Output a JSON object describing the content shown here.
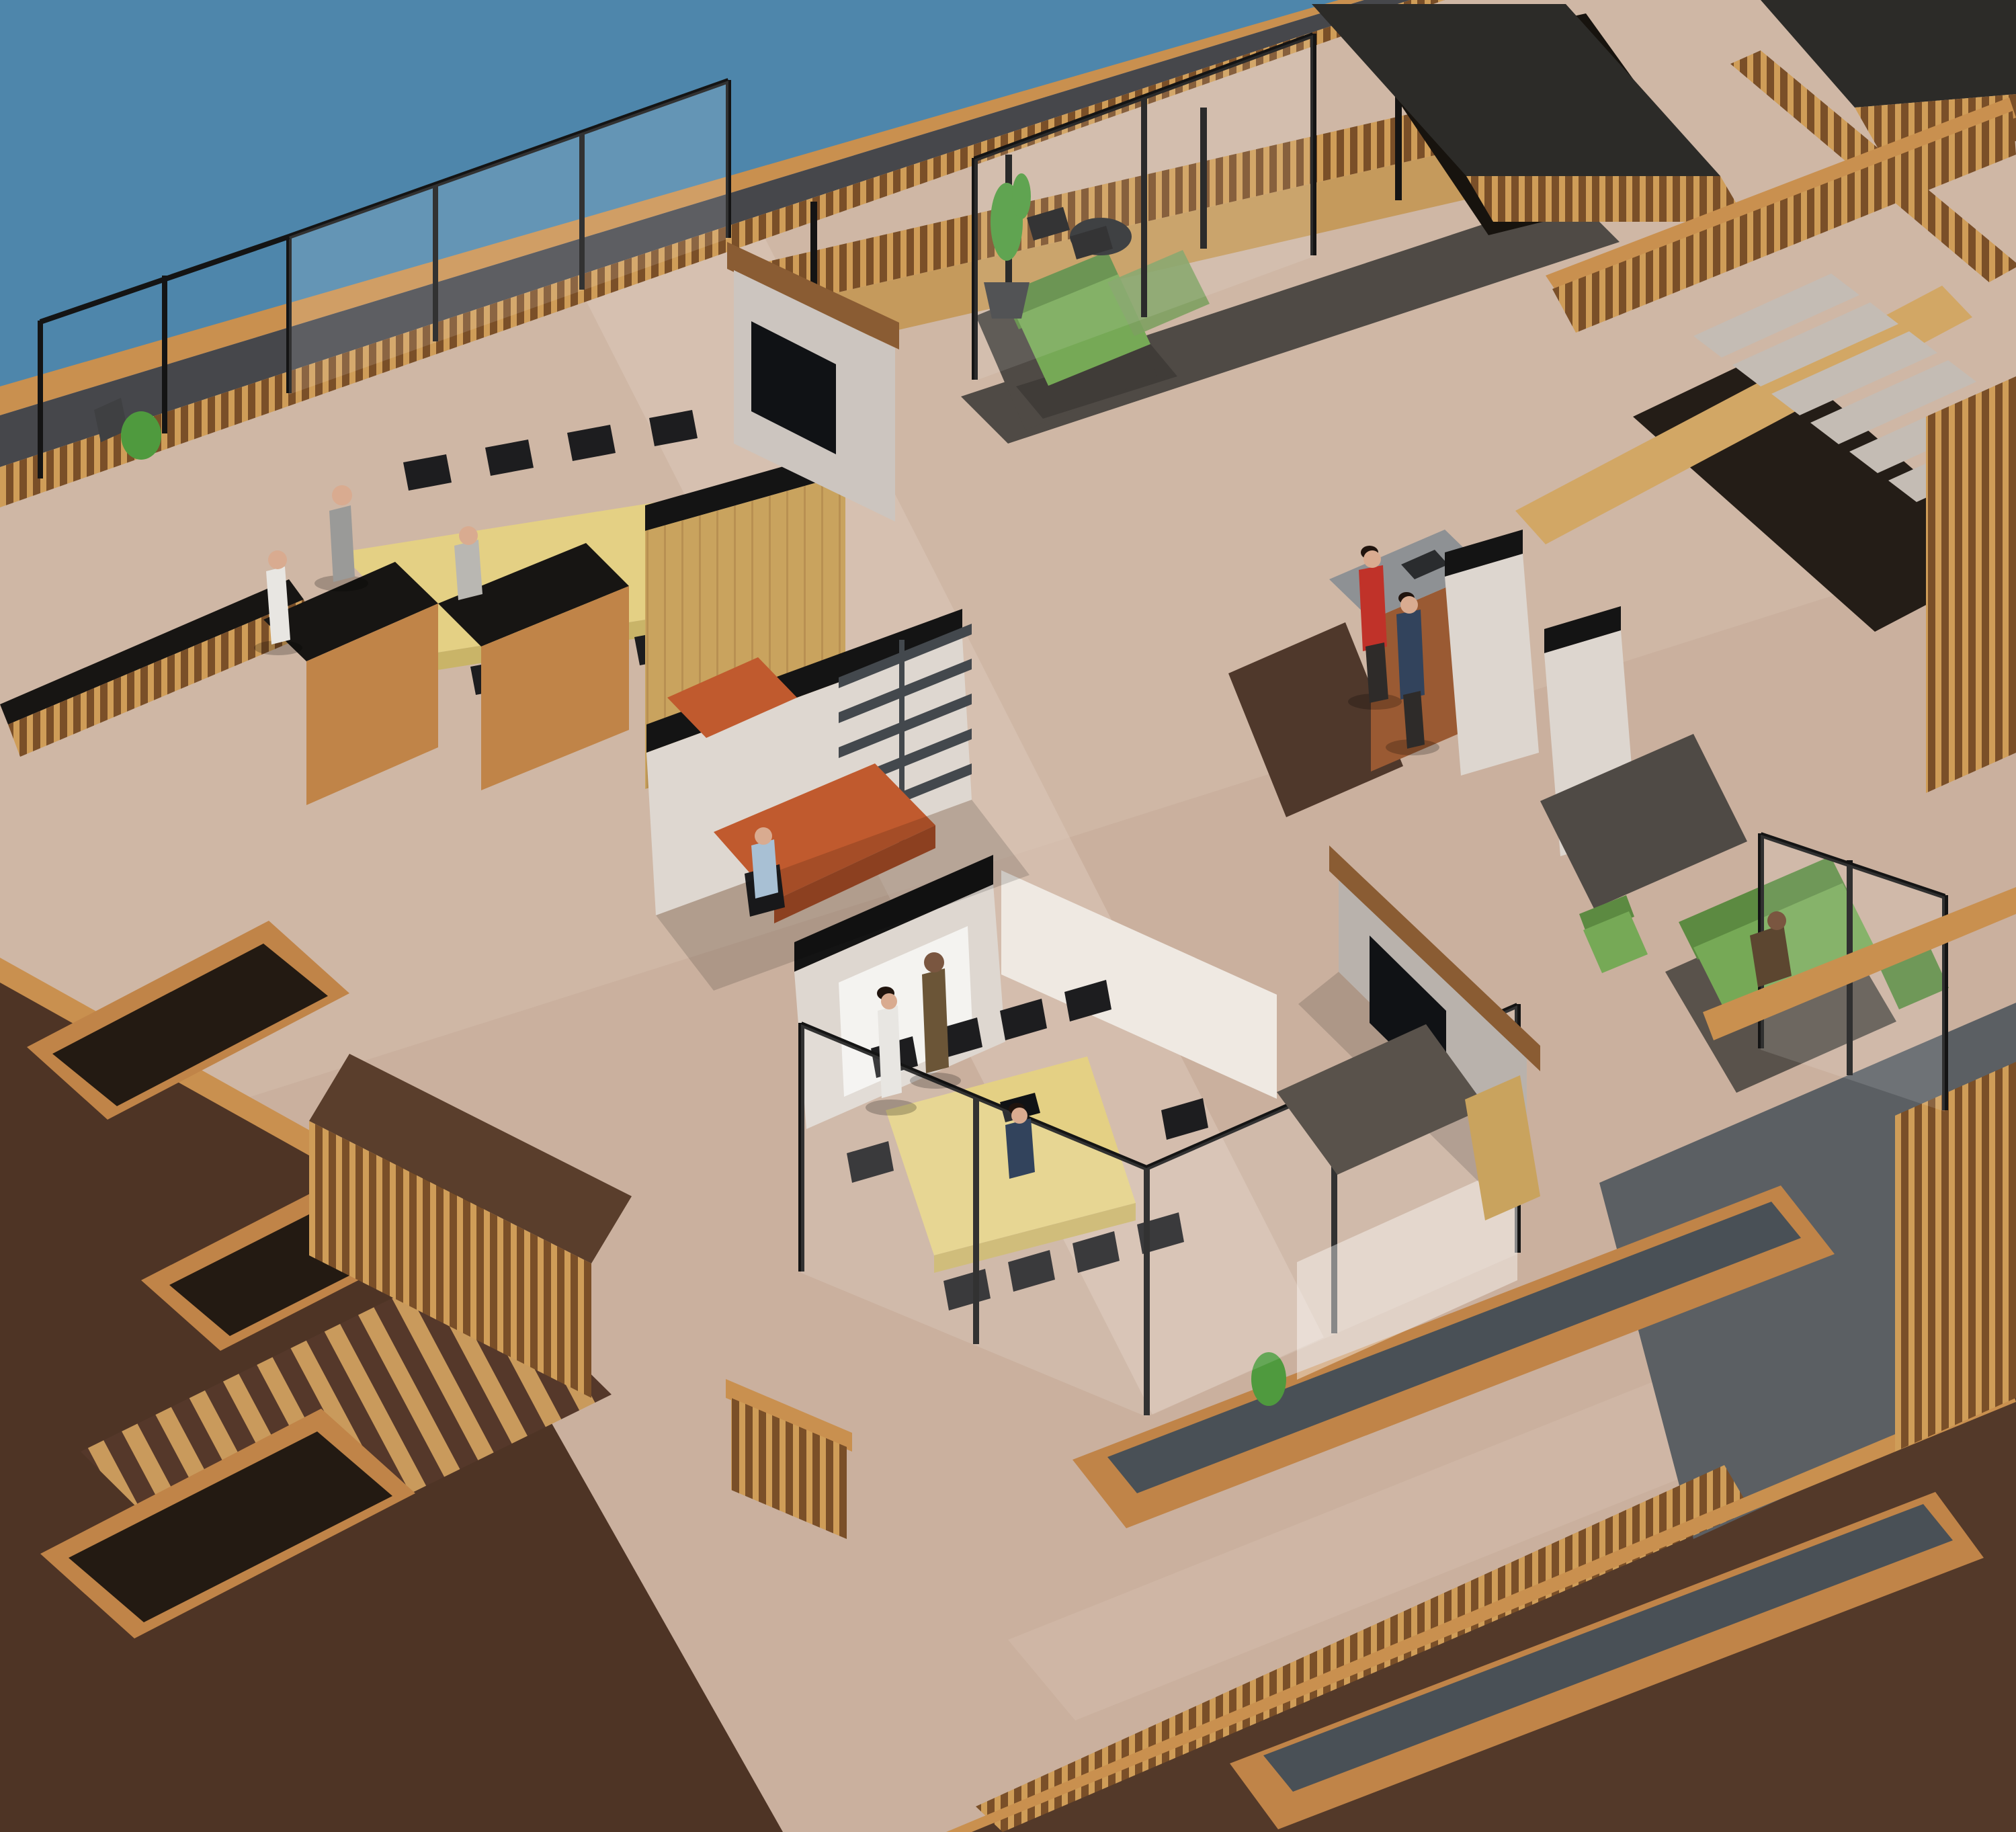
{
  "meta": {
    "kind": "3d-architectural-render",
    "view": "isometric-aerial",
    "subject": "rooftop open-plan office level beside water",
    "has_text": false
  },
  "colors": {
    "water": "#4e86ab",
    "deck_base": "#cfb7a5",
    "deck_shade": "#c3a997",
    "deck_light": "#dcc9b9",
    "wood_rail": "#c9904f",
    "wood_mid": "#c59a5c",
    "wood_light": "#d2a765",
    "wood_face": "#c08448",
    "wood_wall": "#c9a35e",
    "wood_beam": "#8a5c33",
    "wood_dark_base": "#7a4f28",
    "wood_slat": "#cf9d58",
    "gutter": "#46474b",
    "black": "#141414",
    "void": "#17130e",
    "pergola_top": "#2c2b28",
    "terrace_dark": "#4e3425",
    "terrace_dark2": "#533929",
    "terrace_brown": "#5a3e2c",
    "soil": "#231a12",
    "stripe_wood": "#c99a5c",
    "stripe_dark": "#55382a",
    "slate_top": "#495056",
    "slate_gray": "#5b5f63",
    "stair_tread": "#c4bcb4",
    "stair_dark": "#241d17",
    "wall_lit": "#ded7d0",
    "wall_bright": "#efe9e2",
    "wall_part": "#ddd6cf",
    "wall_tv": "#b9b2ac",
    "wall_tv2": "#ccc5bf",
    "board": "#f4f3f0",
    "board_frame": "#b9b4ae",
    "carpet_dark": "#4f4a45",
    "carpet_dark2": "#59524b",
    "floor_darkwood": "#4f382b",
    "table_top": "#e4d084",
    "table_edge": "#c9b468",
    "chair": "#1d1d1f",
    "cab_top": "#171513",
    "desk_orange": "#c05a2e",
    "desk_orange_dark": "#a34b26",
    "shelf": "#43484d",
    "counter_top": "#8e9194",
    "counter_wood": "#9a5a33",
    "appliance": "#2a2c2e",
    "tv": "#101215",
    "sofa_green": "#76a956",
    "sofa_green_dark": "#5c8a41",
    "sofa_muted": "#7da061",
    "plant": "#4f9a3e",
    "pot": "#3f4042",
    "glass": "#ffffff",
    "shadow": "#000000",
    "suit_gray": "#9a9a98",
    "suit_gray_light": "#b9b7b2",
    "suit_white": "#e8e6e2",
    "suit_navy": "#32435c",
    "suit_brown": "#6b5537",
    "suit_brown2": "#5c4630",
    "shirt_blue": "#a8c0d4",
    "sweater_red": "#c03229",
    "pants_dark": "#2e2b29",
    "skin_light": "#d9ab90",
    "skin_dark": "#7a5640",
    "hair_dark": "#20140e"
  },
  "objects": [
    {
      "name": "water",
      "label": "water surface top-left",
      "color_key": "water"
    },
    {
      "name": "main-deck",
      "label": "light travertine rooftop deck",
      "color_key": "deck_base"
    },
    {
      "name": "edge-railing",
      "label": "wood and glass perimeter railing",
      "color_key": "wood_rail"
    },
    {
      "name": "meeting-table-left",
      "label": "long yellow meeting table with black chairs",
      "color_key": "table_top"
    },
    {
      "name": "meeting-table-bottom",
      "label": "second yellow meeting table with laptop",
      "color_key": "table_top"
    },
    {
      "name": "wood-feature-wall",
      "label": "tall oak folding wall of left meeting room",
      "color_key": "wood_wall"
    },
    {
      "name": "tv-walls",
      "label": "two freestanding walls with mounted TVs",
      "color_key": "tv"
    },
    {
      "name": "whiteboard-wall",
      "label": "white wall with whiteboard",
      "color_key": "board"
    },
    {
      "name": "orange-desks",
      "label": "terracotta corner desks in private office",
      "color_key": "desk_orange"
    },
    {
      "name": "shelving-unit",
      "label": "dark wall shelving",
      "color_key": "shelf"
    },
    {
      "name": "kitchen-counter",
      "label": "wood counter with gray top",
      "color_key": "counter_wood"
    },
    {
      "name": "green-sofas",
      "label": "three green sofas and green armchair",
      "color_key": "sofa_green"
    },
    {
      "name": "staircase",
      "label": "concrete stair with wood stringer descending right",
      "color_key": "stair_tread"
    },
    {
      "name": "bridge-walkway",
      "label": "slatted wood bridge walkway top-right",
      "color_key": "wood_mid"
    },
    {
      "name": "pergola-boxes",
      "label": "slatted wood roof structures top-right",
      "color_key": "pergola_top"
    },
    {
      "name": "planter-benches",
      "label": "long wood planter benches with slate tops",
      "color_key": "slate_top"
    },
    {
      "name": "lower-terraces",
      "label": "dark brown lower terraces bottom-left",
      "color_key": "terrace_dark"
    },
    {
      "name": "striped-ramp",
      "label": "striped wood walkway on lower terrace",
      "color_key": "stripe_wood"
    },
    {
      "name": "potted-plant",
      "label": "potted tree beside top sofa",
      "color_key": "plant"
    },
    {
      "name": "glass-partitions",
      "label": "frameless glass partitions with black posts",
      "color_key": "glass"
    }
  ],
  "people": [
    {
      "id": "standing-man-gray-suit",
      "location": "head of left meeting table",
      "clothing": "gray suit",
      "color_key": "suit_gray"
    },
    {
      "id": "standing-woman-white",
      "location": "left end of left meeting table",
      "clothing": "white outfit",
      "color_key": "suit_white"
    },
    {
      "id": "seated-man-gray",
      "location": "near side of left meeting table",
      "clothing": "light gray suit",
      "color_key": "suit_gray_light"
    },
    {
      "id": "seated-person-blue-shirt",
      "location": "orange corner desk",
      "clothing": "light blue shirt",
      "color_key": "shirt_blue"
    },
    {
      "id": "standing-woman-white-2",
      "location": "at whiteboard",
      "clothing": "white outfit",
      "color_key": "suit_white"
    },
    {
      "id": "standing-man-brown-suit",
      "location": "at whiteboard",
      "clothing": "brown suit",
      "color_key": "suit_brown"
    },
    {
      "id": "seated-man-navy",
      "location": "second meeting table with laptop",
      "clothing": "navy suit",
      "color_key": "suit_navy"
    },
    {
      "id": "standing-man-red-sweater",
      "location": "kitchen counter",
      "clothing": "red sweater",
      "color_key": "sweater_red"
    },
    {
      "id": "standing-man-navy-2",
      "location": "kitchen counter",
      "clothing": "navy suit",
      "color_key": "suit_navy"
    },
    {
      "id": "seated-person-sofa",
      "location": "right green sofa",
      "clothing": "brown jacket",
      "color_key": "suit_brown2"
    }
  ]
}
